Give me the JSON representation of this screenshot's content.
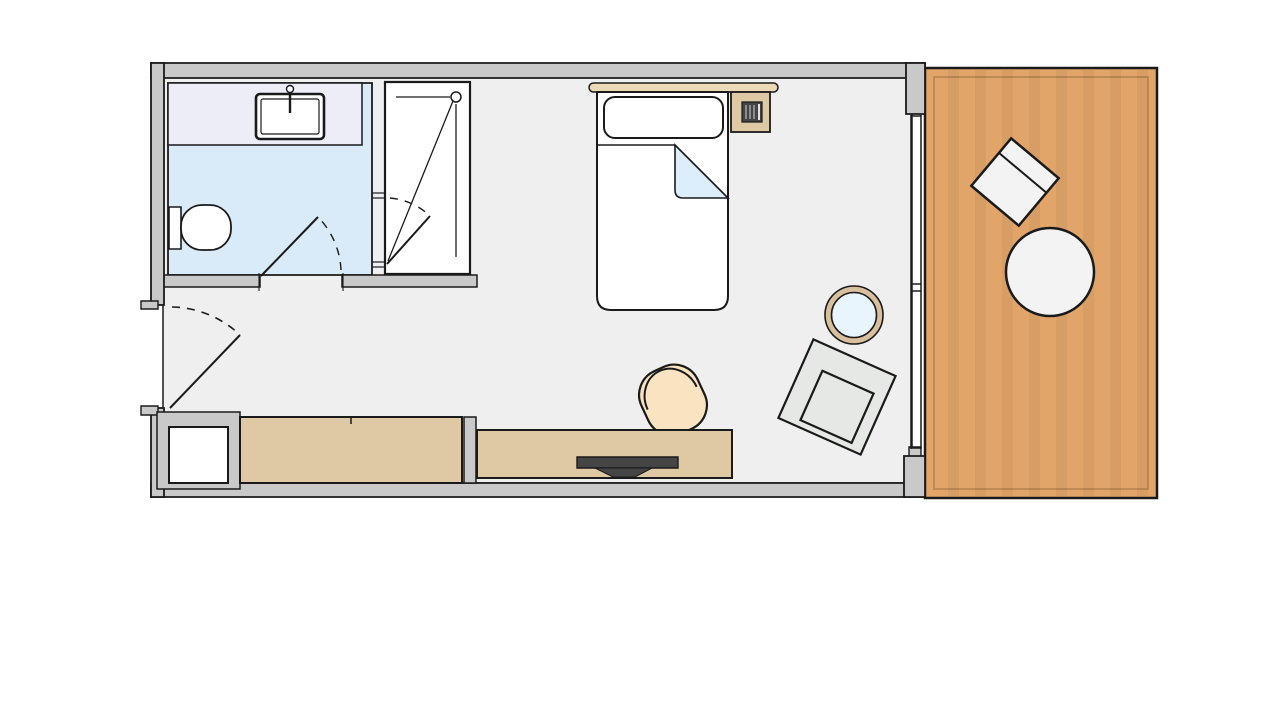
{
  "colors": {
    "background": "#ffffff",
    "line": "#1a1a1a",
    "wall": "#c9c9c9",
    "room_floor": "#efeff0",
    "bathroom_floor": "#d9ebf9",
    "counter": "#ededf8",
    "white": "#ffffff",
    "furniture_tan": "#dfc9a4",
    "headboard_tan": "#ecd9b6",
    "balcony_floor": "#e1a569",
    "balcony_edge": "#bf8b52",
    "sheet_blue": "#dceefb",
    "chair_peach": "#fae3c0",
    "armchair_gray": "#e6e8e5",
    "balcony_furniture_white": "#f3f3f3",
    "tv_dark": "#454545",
    "side_table_ring": "#d8bf9e",
    "side_table_glass": "#e9f5fd"
  },
  "legend": {
    "rooms": [
      "bathroom",
      "shower",
      "bedroom",
      "balcony"
    ],
    "furniture": [
      "washbasin-vanity",
      "toilet",
      "single-bed",
      "nightstand",
      "telephone",
      "wardrobe",
      "luggage-rack",
      "sideboard-desk",
      "tv",
      "desk-chair",
      "armchair",
      "side-table",
      "balcony-chair",
      "balcony-table"
    ],
    "openings": [
      "entry-door",
      "bathroom-door",
      "shower-door",
      "window-door"
    ]
  }
}
